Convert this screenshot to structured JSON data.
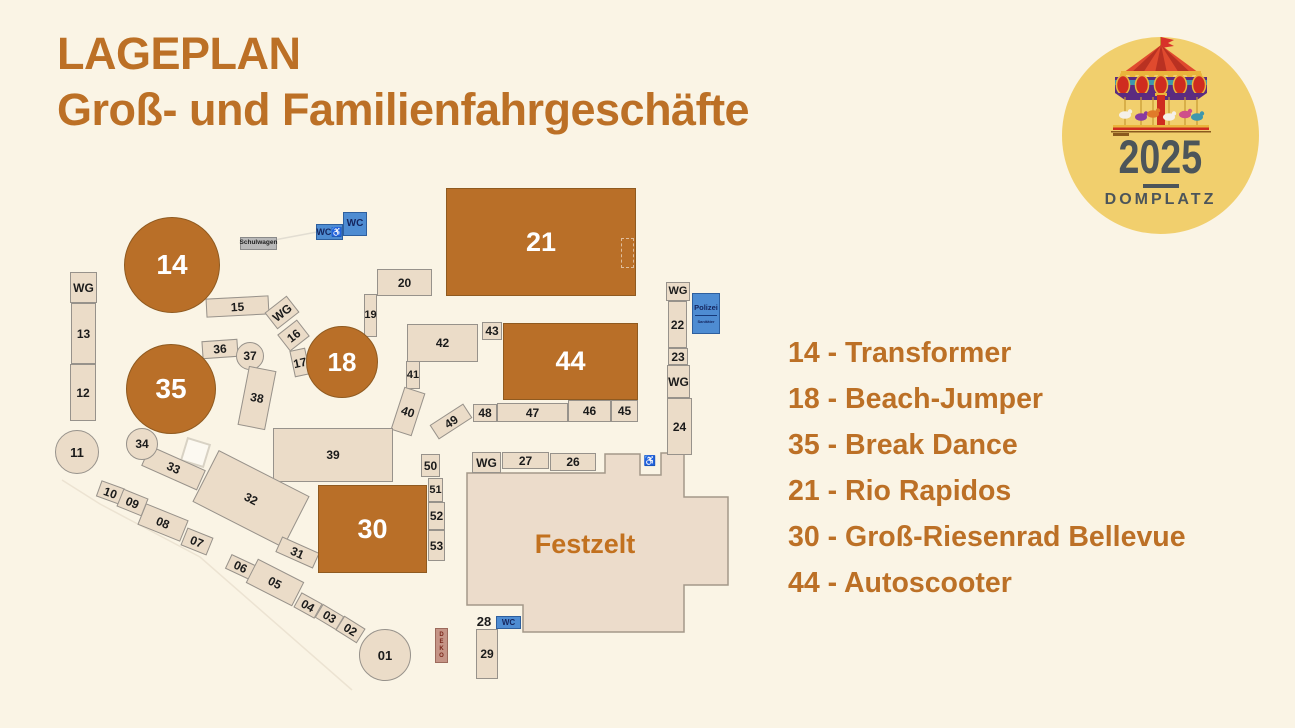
{
  "title": {
    "line1": "LAGEPLAN",
    "line2": "Groß- und Familienfahrgeschäfte"
  },
  "badge": {
    "year": "2025",
    "place": "DOMPLATZ"
  },
  "legend": {
    "items": [
      "14 - Transformer",
      "18 - Beach-Jumper",
      "35 - Break Dance",
      "21 - Rio Rapidos",
      "30 - Groß-Riesenrad Bellevue",
      "44 - Autoscooter"
    ]
  },
  "colors": {
    "accent_text": "#bc7026",
    "ride_fill": "#b96f28",
    "stand_fill": "#ebdcc8",
    "wc_blue": "#4e8cd2",
    "badge_yellow": "#f1cf6d",
    "background": "#faf4e5"
  },
  "map": {
    "festzelt": {
      "label": "Festzelt",
      "points": "467,473 605,473 605,454 640,454 640,475 661,475 661,453 684,453 684,497 728,497 728,585 684,585 684,632 523,632 523,605 467,605"
    },
    "police": {
      "line1": "Polizei",
      "line2": "Sanitäter"
    },
    "plots": [
      {
        "label": "WG",
        "x": 70,
        "y": 272,
        "w": 27,
        "h": 31
      },
      {
        "label": "13",
        "x": 71,
        "y": 303,
        "w": 25,
        "h": 61
      },
      {
        "label": "12",
        "x": 70,
        "y": 364,
        "w": 26,
        "h": 57
      },
      {
        "label": "11",
        "shape": "circle",
        "cx": 77,
        "cy": 452,
        "r": 22,
        "fs": 13
      },
      {
        "label": "",
        "x": 183,
        "y": 440,
        "w": 25,
        "h": 25,
        "rot": 17,
        "style": "ghost",
        "name": "ghost-square"
      },
      {
        "label": "Schulwagen",
        "x": 240,
        "y": 237,
        "w": 37,
        "h": 13,
        "style": "gray",
        "fs": 6.5,
        "name": "schulwagen-box"
      },
      {
        "label": "WC♿",
        "x": 316,
        "y": 224,
        "w": 27,
        "h": 16,
        "style": "wc",
        "fs": 9,
        "name": "wc-accessible-box"
      },
      {
        "label": "WC",
        "x": 343,
        "y": 212,
        "w": 24,
        "h": 24,
        "style": "wc",
        "fs": 10,
        "name": "wc-box"
      },
      {
        "label": "15",
        "x": 206,
        "y": 297,
        "w": 63,
        "h": 19,
        "rot": -3
      },
      {
        "label": "WG",
        "x": 268,
        "y": 302,
        "w": 28,
        "h": 21,
        "rot": -38
      },
      {
        "label": "16",
        "x": 281,
        "y": 325,
        "w": 25,
        "h": 21,
        "rot": -38
      },
      {
        "label": "17",
        "x": 292,
        "y": 349,
        "w": 16,
        "h": 27,
        "rot": -12
      },
      {
        "label": "19",
        "x": 364,
        "y": 294,
        "w": 13,
        "h": 43,
        "fs": 11
      },
      {
        "label": "20",
        "x": 377,
        "y": 269,
        "w": 55,
        "h": 27
      },
      {
        "label": "36",
        "x": 202,
        "y": 340,
        "w": 36,
        "h": 18,
        "rot": -4
      },
      {
        "label": "37",
        "shape": "circle",
        "cx": 250,
        "cy": 356,
        "r": 14,
        "fs": 12
      },
      {
        "label": "38",
        "x": 243,
        "y": 368,
        "w": 28,
        "h": 60,
        "rot": 11
      },
      {
        "label": "42",
        "x": 407,
        "y": 324,
        "w": 71,
        "h": 38
      },
      {
        "label": "43",
        "x": 482,
        "y": 322,
        "w": 20,
        "h": 18
      },
      {
        "label": "41",
        "x": 406,
        "y": 361,
        "w": 14,
        "h": 28,
        "fs": 11
      },
      {
        "label": "40",
        "x": 397,
        "y": 389,
        "w": 22,
        "h": 45,
        "rot": 18
      },
      {
        "label": "48",
        "x": 473,
        "y": 404,
        "w": 24,
        "h": 18
      },
      {
        "label": "47",
        "x": 497,
        "y": 403,
        "w": 71,
        "h": 19
      },
      {
        "label": "46",
        "x": 568,
        "y": 400,
        "w": 43,
        "h": 22
      },
      {
        "label": "45",
        "x": 611,
        "y": 400,
        "w": 27,
        "h": 22
      },
      {
        "label": "49",
        "x": 431,
        "y": 413,
        "w": 40,
        "h": 17,
        "rot": -33
      },
      {
        "label": "50",
        "x": 421,
        "y": 454,
        "w": 19,
        "h": 23
      },
      {
        "label": "51",
        "x": 428,
        "y": 478,
        "w": 15,
        "h": 24,
        "fs": 11
      },
      {
        "label": "52",
        "x": 428,
        "y": 502,
        "w": 17,
        "h": 28
      },
      {
        "label": "53",
        "x": 428,
        "y": 530,
        "w": 17,
        "h": 31
      },
      {
        "label": "WG",
        "x": 666,
        "y": 282,
        "w": 24,
        "h": 19,
        "fs": 11
      },
      {
        "label": "22",
        "x": 668,
        "y": 301,
        "w": 19,
        "h": 47
      },
      {
        "label": "23",
        "x": 668,
        "y": 348,
        "w": 20,
        "h": 17
      },
      {
        "label": "WG",
        "x": 667,
        "y": 365,
        "w": 23,
        "h": 33
      },
      {
        "label": "24",
        "x": 667,
        "y": 398,
        "w": 25,
        "h": 57
      },
      {
        "label": "♿",
        "x": 642,
        "y": 455,
        "w": 16,
        "h": 14,
        "style": "plain",
        "fs": 10,
        "name": "wheelchair-icon"
      },
      {
        "label": "39",
        "x": 273,
        "y": 428,
        "w": 120,
        "h": 54
      },
      {
        "label": "33",
        "x": 143,
        "y": 457,
        "w": 61,
        "h": 22,
        "rot": 24
      },
      {
        "label": "32",
        "x": 200,
        "y": 470,
        "w": 102,
        "h": 58,
        "rot": 27
      },
      {
        "label": "31",
        "x": 277,
        "y": 544,
        "w": 41,
        "h": 17,
        "rot": 24
      },
      {
        "label": "10",
        "x": 98,
        "y": 484,
        "w": 25,
        "h": 17,
        "rot": 20
      },
      {
        "label": "09",
        "x": 119,
        "y": 493,
        "w": 27,
        "h": 19,
        "rot": 22
      },
      {
        "label": "08",
        "x": 140,
        "y": 511,
        "w": 46,
        "h": 23,
        "rot": 22
      },
      {
        "label": "07",
        "x": 183,
        "y": 532,
        "w": 28,
        "h": 19,
        "rot": 22
      },
      {
        "label": "06",
        "x": 227,
        "y": 559,
        "w": 27,
        "h": 16,
        "rot": 25
      },
      {
        "label": "05",
        "x": 249,
        "y": 569,
        "w": 52,
        "h": 27,
        "rot": 27
      },
      {
        "label": "04",
        "x": 296,
        "y": 597,
        "w": 24,
        "h": 17,
        "rot": 29
      },
      {
        "label": "03",
        "x": 317,
        "y": 609,
        "w": 25,
        "h": 16,
        "rot": 31
      },
      {
        "label": "02",
        "x": 338,
        "y": 621,
        "w": 25,
        "h": 17,
        "rot": 32
      },
      {
        "label": "01",
        "shape": "circle",
        "cx": 385,
        "cy": 655,
        "r": 26,
        "fs": 13
      },
      {
        "label": "DEKO",
        "x": 435,
        "y": 628,
        "w": 13,
        "h": 35,
        "style": "deko",
        "fs": 6,
        "name": "deko-box"
      },
      {
        "label": "WG",
        "x": 472,
        "y": 452,
        "w": 29,
        "h": 21
      },
      {
        "label": "27",
        "x": 502,
        "y": 452,
        "w": 47,
        "h": 17
      },
      {
        "label": "26",
        "x": 550,
        "y": 453,
        "w": 46,
        "h": 18
      },
      {
        "label": "28",
        "x": 472,
        "y": 613,
        "w": 24,
        "h": 16,
        "style": "plain",
        "fs": 13
      },
      {
        "label": "WC",
        "x": 496,
        "y": 616,
        "w": 25,
        "h": 13,
        "style": "wc",
        "fs": 8,
        "name": "wc-box"
      },
      {
        "label": "29",
        "x": 476,
        "y": 629,
        "w": 22,
        "h": 50
      },
      {
        "label": "14",
        "shape": "circle",
        "cx": 172,
        "cy": 265,
        "r": 48,
        "style": "ride",
        "fs": 28
      },
      {
        "label": "35",
        "shape": "circle",
        "cx": 171,
        "cy": 389,
        "r": 45,
        "style": "ride",
        "fs": 28
      },
      {
        "label": "18",
        "shape": "circle",
        "cx": 342,
        "cy": 362,
        "r": 36,
        "style": "ride",
        "fs": 26
      },
      {
        "label": "34",
        "shape": "circle",
        "cx": 142,
        "cy": 444,
        "r": 16,
        "fs": 12
      },
      {
        "label": "21",
        "x": 446,
        "y": 188,
        "w": 190,
        "h": 108,
        "style": "ride",
        "fs": 27
      },
      {
        "label": "44",
        "x": 503,
        "y": 323,
        "w": 135,
        "h": 77,
        "style": "ride",
        "fs": 27
      },
      {
        "label": "30",
        "x": 318,
        "y": 485,
        "w": 109,
        "h": 88,
        "style": "ride",
        "fs": 27
      },
      {
        "label": "",
        "x": 621,
        "y": 238,
        "w": 13,
        "h": 30,
        "style": "dashed",
        "name": "dashed-area"
      }
    ]
  }
}
